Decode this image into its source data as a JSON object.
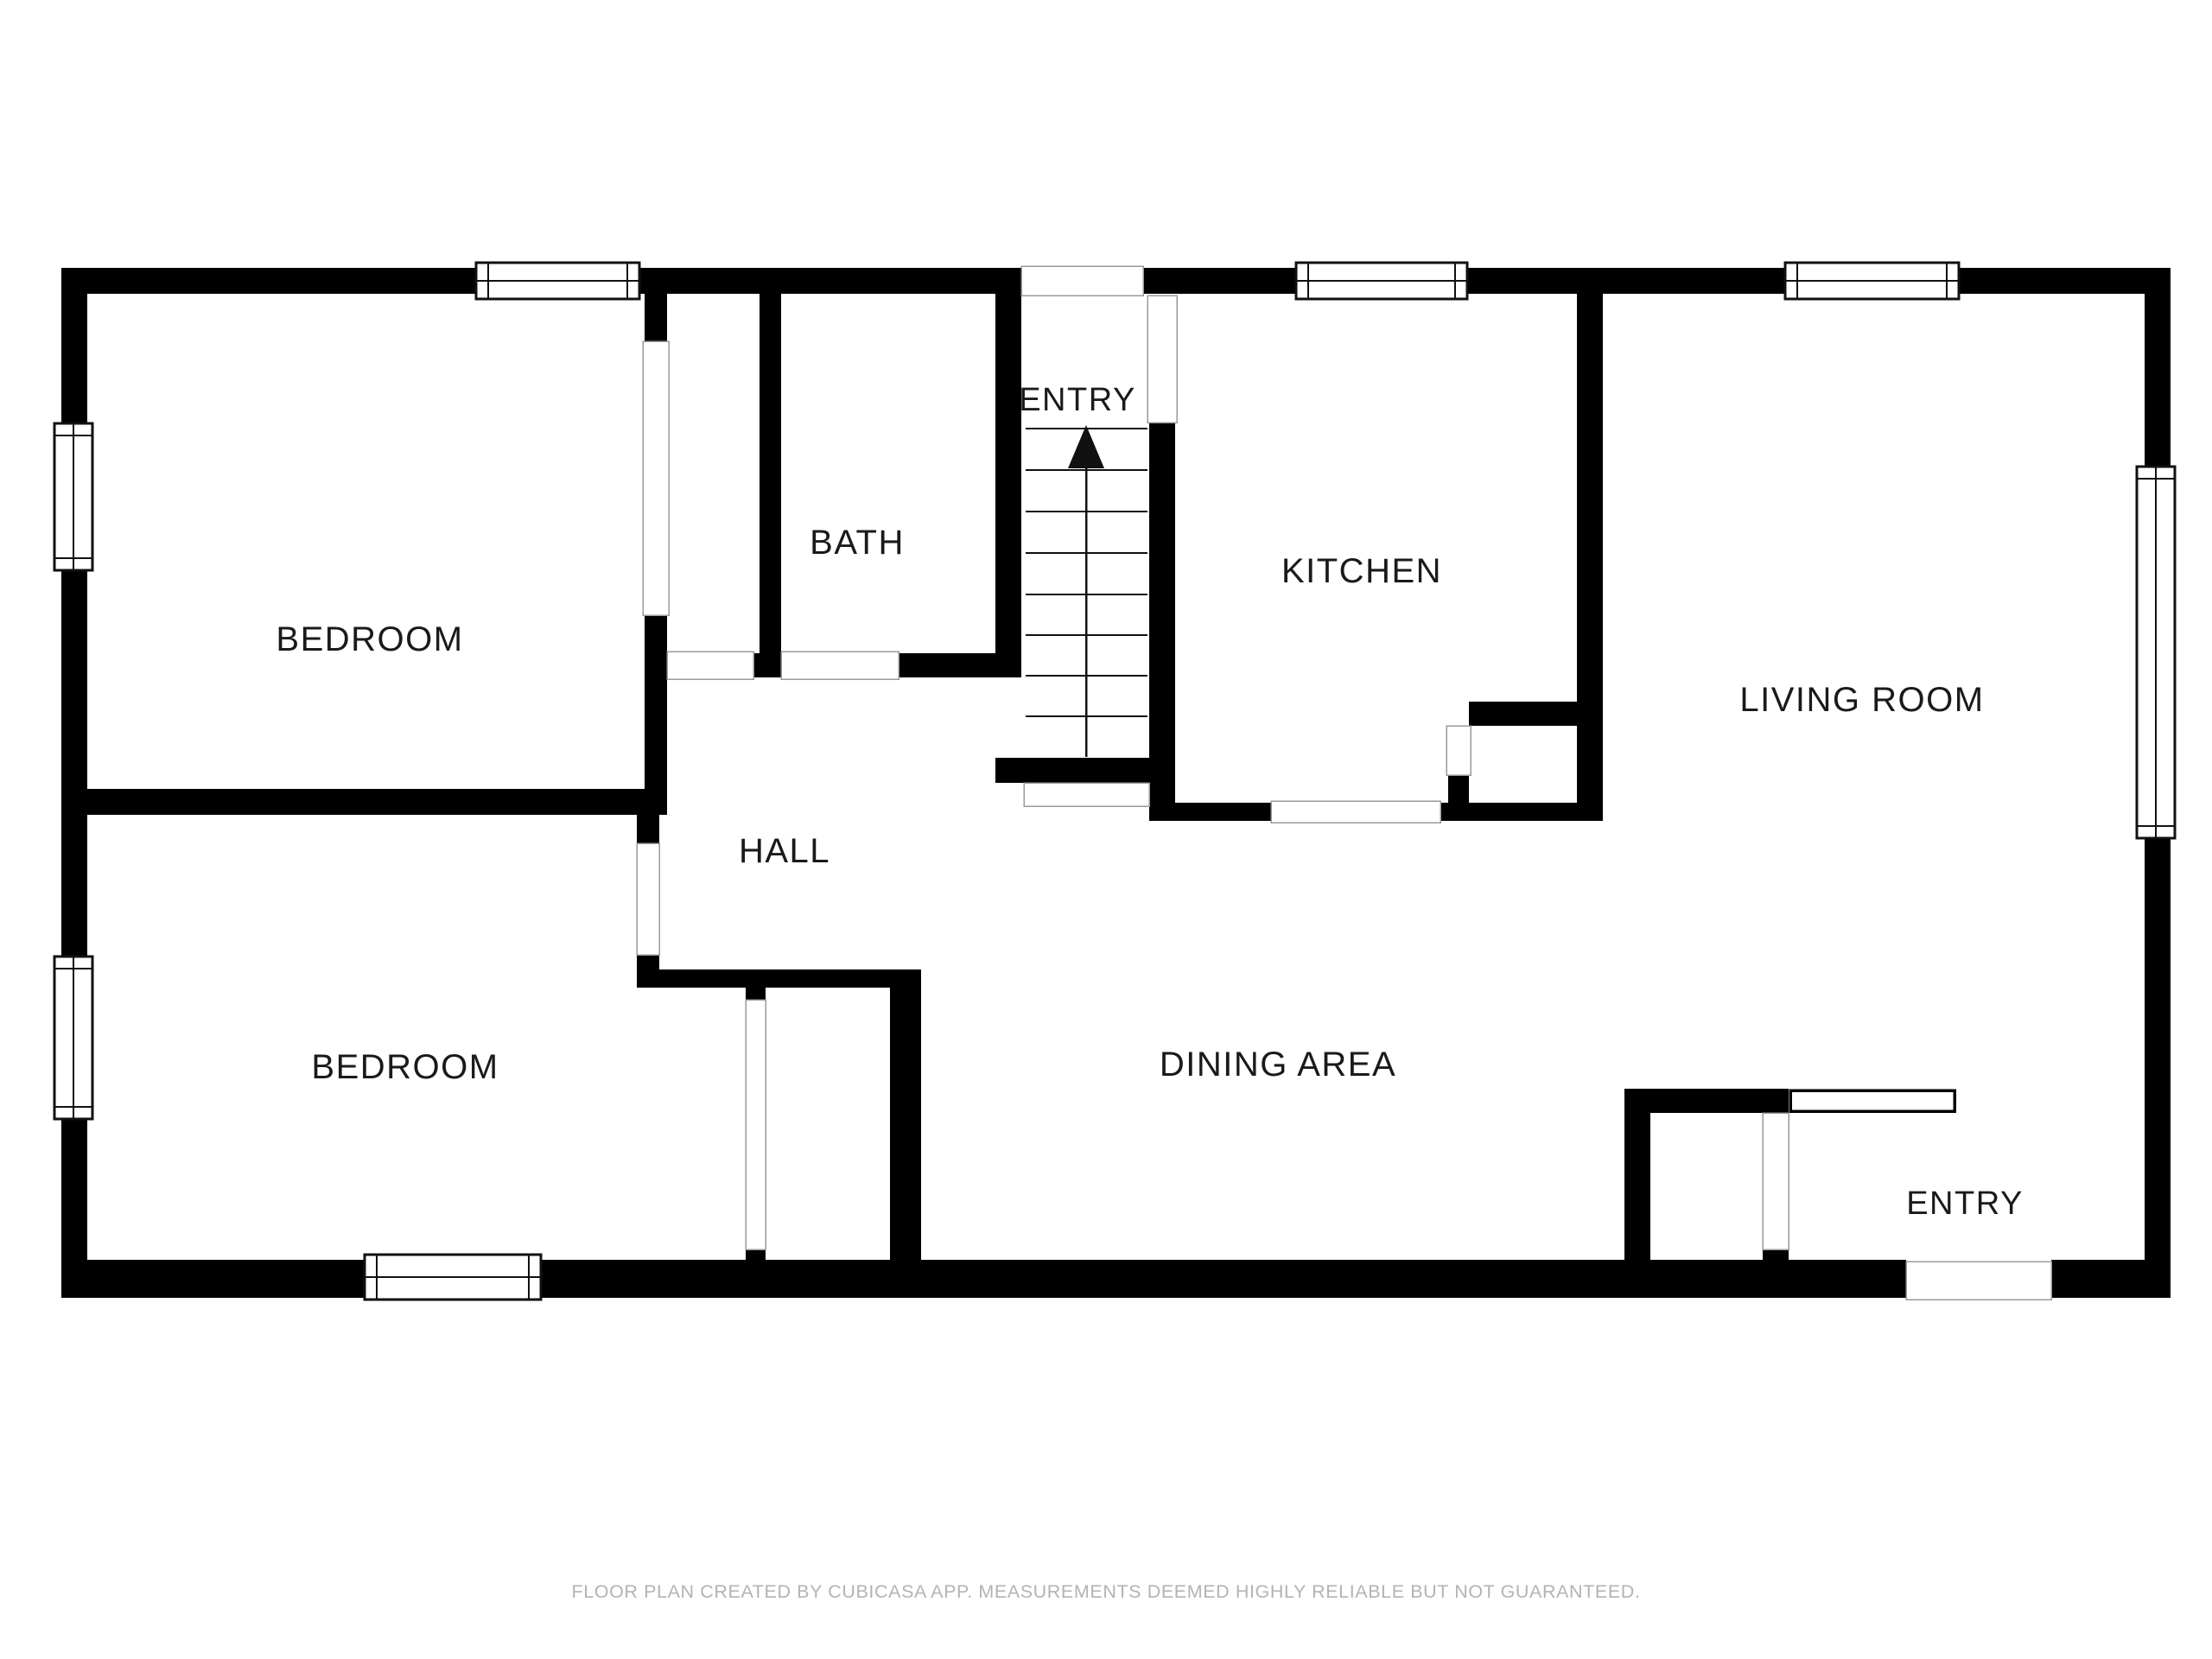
{
  "title": "Floor plan",
  "colors": {
    "background": "#ffffff",
    "wall": "#000000",
    "label_text": "#1a1a1a",
    "threshold_line": "#9a9a9a",
    "footer_text": "#b3b3b3"
  },
  "rooms": [
    {
      "id": "bedroom-1",
      "label": "BEDROOM"
    },
    {
      "id": "bath",
      "label": "BATH"
    },
    {
      "id": "entry-top",
      "label": "ENTRY"
    },
    {
      "id": "kitchen",
      "label": "KITCHEN"
    },
    {
      "id": "living-room",
      "label": "LIVING ROOM"
    },
    {
      "id": "hall",
      "label": "HALL"
    },
    {
      "id": "bedroom-2",
      "label": "BEDROOM"
    },
    {
      "id": "dining-area",
      "label": "DINING AREA"
    },
    {
      "id": "entry-bottom",
      "label": "ENTRY"
    }
  ],
  "stairs": {
    "direction": "up",
    "icon": "stairs-up-arrow",
    "steps": 8
  },
  "windows_count": 7,
  "footer": {
    "text": "FLOOR PLAN CREATED BY CUBICASA APP. MEASUREMENTS DEEMED HIGHLY RELIABLE BUT NOT GUARANTEED."
  }
}
